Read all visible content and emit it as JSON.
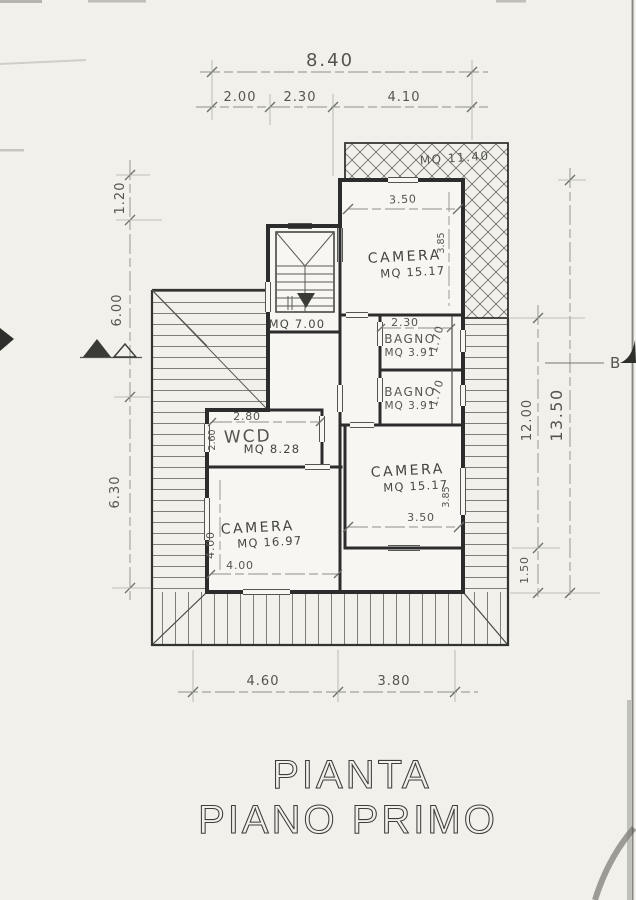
{
  "title": {
    "line1": "PIANTA",
    "line2": "PIANO PRIMO"
  },
  "rooms": {
    "terrace": {
      "area": "MQ 11.40"
    },
    "stairwell": {
      "area": "MQ 7.00"
    },
    "camera_top": {
      "name": "CAMERA",
      "area": "MQ 15.17",
      "width": "3.50",
      "depth": "3.85"
    },
    "bagno_upper": {
      "name": "BAGNO",
      "area": "MQ 3.91",
      "width": "2.30",
      "depth": "1.70"
    },
    "bagno_lower": {
      "name": "BAGNO",
      "area": "MQ 3.91",
      "depth": "1.70"
    },
    "wcd": {
      "name": "WCD",
      "area": "MQ 8.28",
      "width": "2.80",
      "depth": "2.60"
    },
    "camera_left": {
      "name": "CAMERA",
      "area": "MQ 16.97",
      "width": "4.00",
      "depth": "4.00"
    },
    "camera_right": {
      "name": "CAMERA",
      "area": "MQ 15.17",
      "width": "3.50",
      "depth": "3.85"
    }
  },
  "dimensions": {
    "top_total": "8.40",
    "top_segments": [
      "2.00",
      "2.30",
      "4.10"
    ],
    "bottom_segments": [
      "4.60",
      "3.80"
    ],
    "left_segments": [
      "1.20",
      "6.00",
      "6.30"
    ],
    "right_depth": "12.00",
    "right_total": "13.50",
    "right_balcony": "1.50"
  },
  "markers": {
    "section_b": "B"
  }
}
